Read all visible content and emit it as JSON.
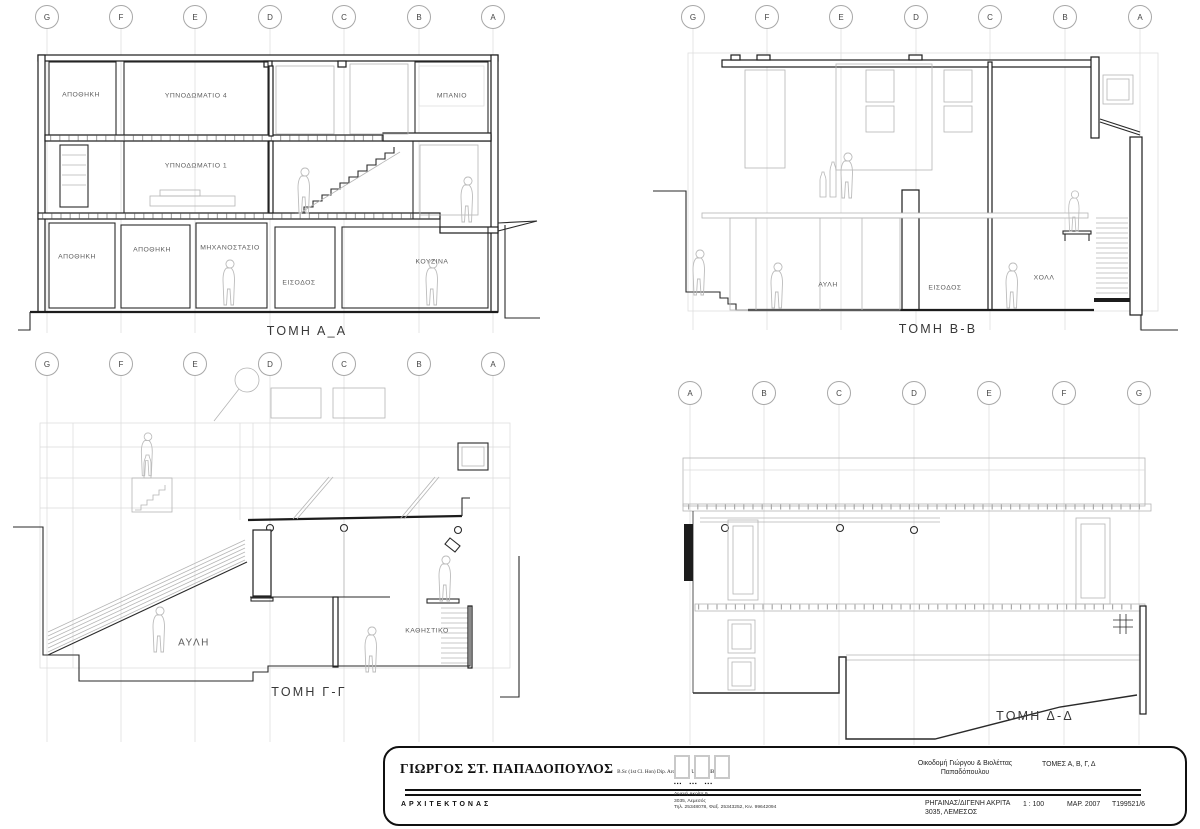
{
  "sheet": {
    "background": "#ffffff",
    "line_dark": "#2a2a2a",
    "line_light": "#b5b5b5",
    "line_faint": "#dadada"
  },
  "sections": {
    "aa": {
      "title": "ΤΟΜΗ Α_Α",
      "grid": [
        "G",
        "F",
        "E",
        "D",
        "C",
        "B",
        "A"
      ],
      "rooms": {
        "apothiki_top": "ΑΠΟΘΗΚΗ",
        "ypnodomatio4": "ΥΠΝΟΔΩΜΑΤΙΟ 4",
        "mpanio": "ΜΠΑΝΙΟ",
        "ypnodomatio1": "ΥΠΝΟΔΩΜΑΤΙΟ 1",
        "apothiki_g1": "ΑΠΟΘΗΚΗ",
        "apothiki_g2": "ΑΠΟΘΗΚΗ",
        "mixanostasio": "ΜΗΧΑΝΟΣΤΑΣΙΟ",
        "eisodos": "ΕΙΣΟΔΟΣ",
        "kouzina": "ΚΟΥΖΙΝΑ"
      }
    },
    "bb": {
      "title": "ΤΟΜΗ Β-Β",
      "grid": [
        "G",
        "F",
        "E",
        "D",
        "C",
        "B",
        "A"
      ],
      "rooms": {
        "avli": "ΑΥΛΗ",
        "eisodos": "ΕΙΣΟΔΟΣ",
        "xoll": "ΧΟΛΛ"
      }
    },
    "gg": {
      "title": "ΤΟΜΗ Γ-Γ",
      "grid": [
        "G",
        "F",
        "E",
        "D",
        "C",
        "B",
        "A"
      ],
      "rooms": {
        "avli": "ΑΥΛΗ",
        "kathistiko": "ΚΑΘΗΣΤΙΚΟ"
      }
    },
    "dd": {
      "title": "ΤΟΜΗ Δ-Δ",
      "grid": [
        "A",
        "B",
        "C",
        "D",
        "E",
        "F",
        "G"
      ]
    }
  },
  "titleblock": {
    "architect": "ΓΙΩΡΓΟΣ ΣΤ. ΠΑΠΑΔΟΠΟΥΛΟΣ",
    "credentials": "B.Sc (1st Cl. Hon) Dip. Arch (Lon. Univ.) RIBA",
    "profession": "ΑΡΧΙΤΕΚΤΟΝΑΣ",
    "office_address_1": "Διγενή Ακρίτα 9",
    "office_address_2": "3035, Λεμεσός",
    "office_contact": "Τηλ. 25348078, Φαξ. 25343252, Κιν. 99642094",
    "project_1": "Οικοδομή Γιώργου & Βιολέττας",
    "project_2": "Παπαδόπουλου",
    "drawing_title": "ΤΟΜΕΣ Α, Β, Γ, Δ",
    "site_1": "ΡΗΓΑΙΝΑΣ/ΔΙΓΕΝΗ ΑΚΡΙΤΑ",
    "site_2": "3035, ΛΕΜΕΣΟΣ",
    "scale": "1 : 100",
    "date": "ΜΑΡ. 2007",
    "drawing_no": "T199521/6"
  }
}
